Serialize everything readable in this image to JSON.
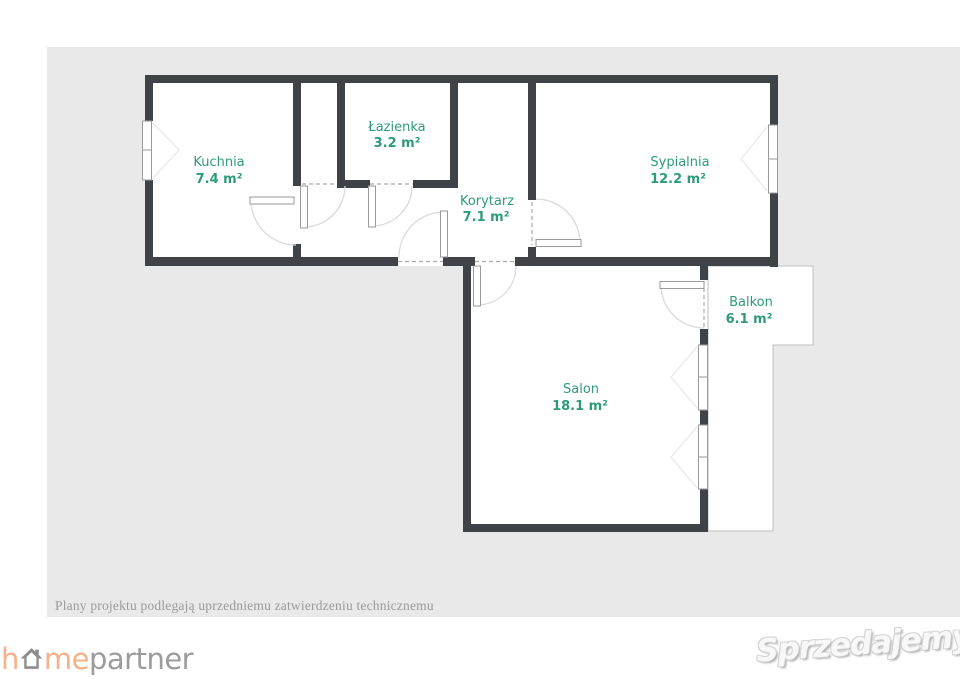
{
  "colors": {
    "canvas_bg": "#e9e9e9",
    "wall": "#3f4347",
    "room_label": "#2d9b7b",
    "door_arc": "#dadada",
    "balcony_outline": "#c9c9c9",
    "logo_orange": "#f6b188",
    "logo_gray": "#9c9c9c",
    "badge_red": "#e23b3f"
  },
  "floorplan": {
    "rooms": [
      {
        "id": "kuchnia",
        "name": "Kuchnia",
        "area": "7.4 m²"
      },
      {
        "id": "lazienka",
        "name": "Łazienka",
        "area": "3.2 m²"
      },
      {
        "id": "korytarz",
        "name": "Korytarz",
        "area": "7.1 m²"
      },
      {
        "id": "sypialnia",
        "name": "Sypialnia",
        "area": "12.2 m²"
      },
      {
        "id": "salon",
        "name": "Salon",
        "area": "18.1 m²"
      },
      {
        "id": "balkon",
        "name": "Balkon",
        "area": "6.1 m²"
      }
    ]
  },
  "footer": {
    "disclaimer": "Plany projektu podlegają uprzedniemu zatwierdzeniu technicznemu"
  },
  "branding": {
    "homepartner": {
      "part1": "h",
      "part2": "me",
      "part3": "partner"
    },
    "sprzedajemy": {
      "text": "Sprzedajemy",
      "badge": "pl"
    }
  }
}
